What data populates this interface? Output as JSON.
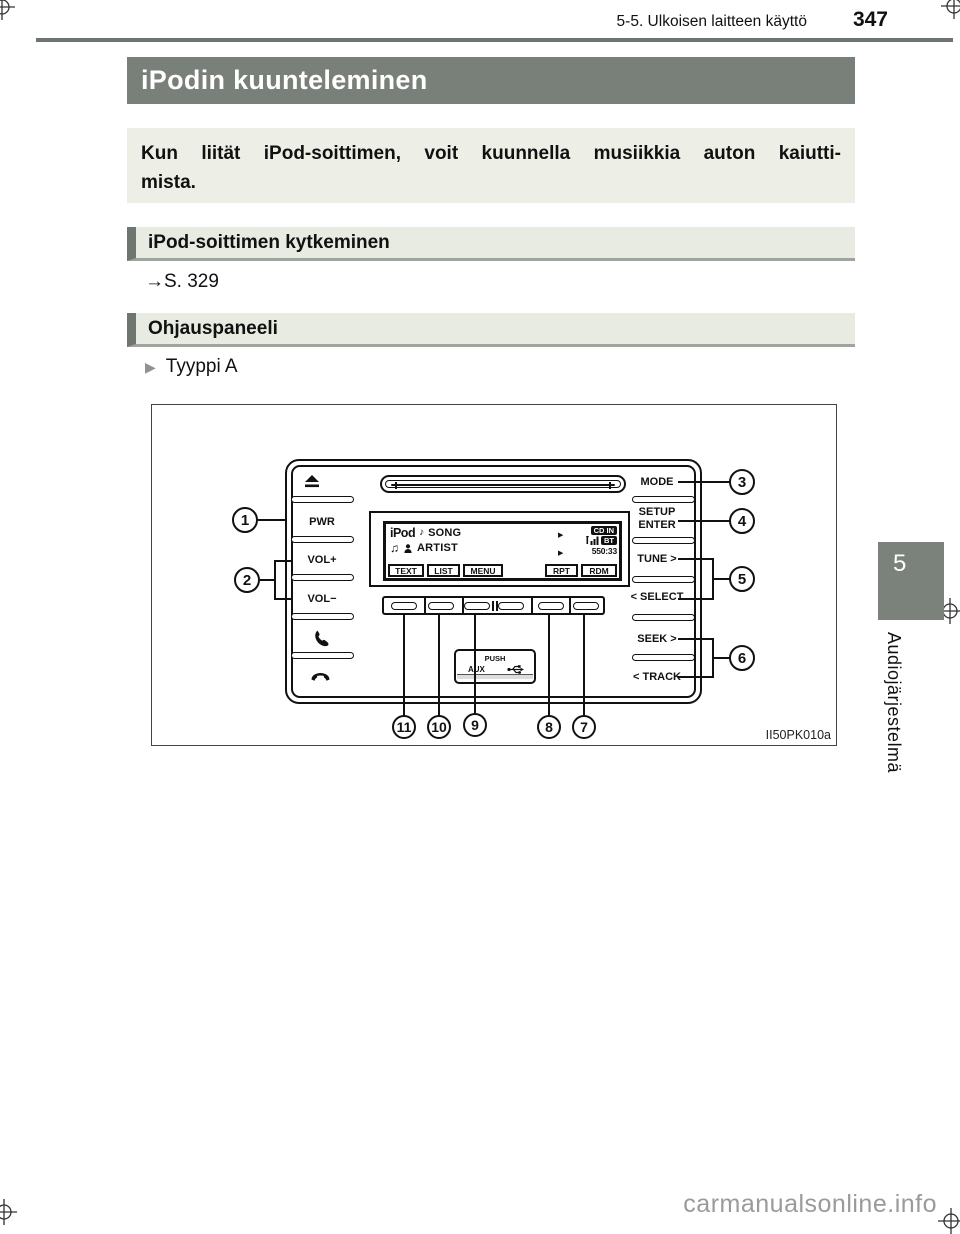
{
  "header": {
    "section_title": "5-5. Ulkoisen laitteen käyttö",
    "page_number": "347"
  },
  "title_bar": "iPodin kuunteleminen",
  "intro": {
    "line1": "Kun liität iPod-soittimen, voit kuunnella musiikkia auton kaiutti-",
    "line2": "mista."
  },
  "connect_section": {
    "heading": "iPod-soittimen kytkeminen",
    "reference": "→S. 329"
  },
  "panel_section": {
    "heading": "Ohjauspaneeli",
    "marker": "▶",
    "variant": "Tyyppi A"
  },
  "diagram": {
    "figure_code": "II50PK010a",
    "left_buttons": {
      "power": "PWR",
      "volume_up": "VOL+",
      "volume_down": "VOL−"
    },
    "right_buttons": {
      "mode": "MODE",
      "setup": "SETUP",
      "enter": "ENTER",
      "tune": "TUNE >",
      "select": "< SELECT",
      "seek": "SEEK >",
      "track": "< TRACK"
    },
    "display": {
      "source": "iPod",
      "note": "♪",
      "song": "SONG",
      "notes": "♫",
      "artist": "ARTIST",
      "play1": "▶",
      "play2": "▶",
      "cd_badge": "CD IN",
      "bt_badge": "BT",
      "counter": "550:33",
      "keys": [
        "TEXT",
        "LIST",
        "MENU",
        "RPT",
        "RDM"
      ]
    },
    "aux": {
      "push": "PUSH",
      "label": "AUX"
    },
    "callouts": [
      "1",
      "2",
      "3",
      "4",
      "5",
      "6",
      "7",
      "8",
      "9",
      "10",
      "11"
    ]
  },
  "sidebar": {
    "tab": "5",
    "chapter": "Audiojärjestelmä"
  },
  "watermark": "carmanualsonline.info",
  "colors": {
    "accent_gray": "#79807a",
    "section_bg": "#e8ebe2",
    "intro_bg": "#edefe7"
  }
}
